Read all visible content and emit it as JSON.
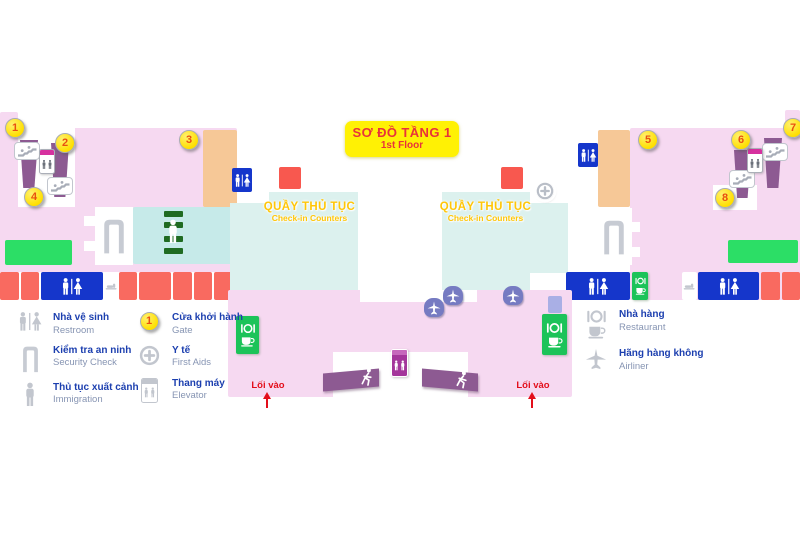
{
  "floor_plan": {
    "title_vi": "SƠ ĐỒ TẦNG 1",
    "title_en": "1st Floor",
    "checkin_vi": "QUẦY THỦ TỤC",
    "checkin_en": "Check-in Counters",
    "entrance_label": "Lối vào",
    "gate_numbers": [
      "1",
      "2",
      "3",
      "4",
      "5",
      "6",
      "7",
      "8"
    ]
  },
  "legend": {
    "restroom": {
      "vi": "Nhà vệ sinh",
      "en": "Restroom"
    },
    "security": {
      "vi": "Kiểm tra an ninh",
      "en": "Security Check"
    },
    "immigration": {
      "vi": "Thủ tục xuất cảnh",
      "en": "Immigration"
    },
    "gate": {
      "vi": "Cửa khởi hành",
      "en": "Gate",
      "badge": "1"
    },
    "first_aid": {
      "vi": "Y tế",
      "en": "First Aids"
    },
    "elevator": {
      "vi": "Thang máy",
      "en": "Elevator"
    },
    "restaurant": {
      "vi": "Nhà hàng",
      "en": "Restaurant"
    },
    "airliner": {
      "vi": "Hãng hàng không",
      "en": "Airliner"
    }
  },
  "colors": {
    "zone_pink": "#F6D9F1",
    "checkin_teal": "#DCF1EE",
    "immigration_teal": "#C6EAE9",
    "orange_zone": "#F6C897",
    "salmon_block": "#F96A60",
    "gate_red": "#F8584F",
    "green_zone": "#2CDE66",
    "restroom_blue": "#1536CB",
    "escalator_purple": "#8D5A92",
    "gate_circle_yellow": "#FFDF00",
    "title_yellow": "#FFF104",
    "title_red": "#E8333A",
    "checkin_text_yellow": "#FFC608",
    "entrance_red": "#E30E1B",
    "legend_vi_blue": "#1C3FAF",
    "legend_en_gray": "#8795B3"
  }
}
